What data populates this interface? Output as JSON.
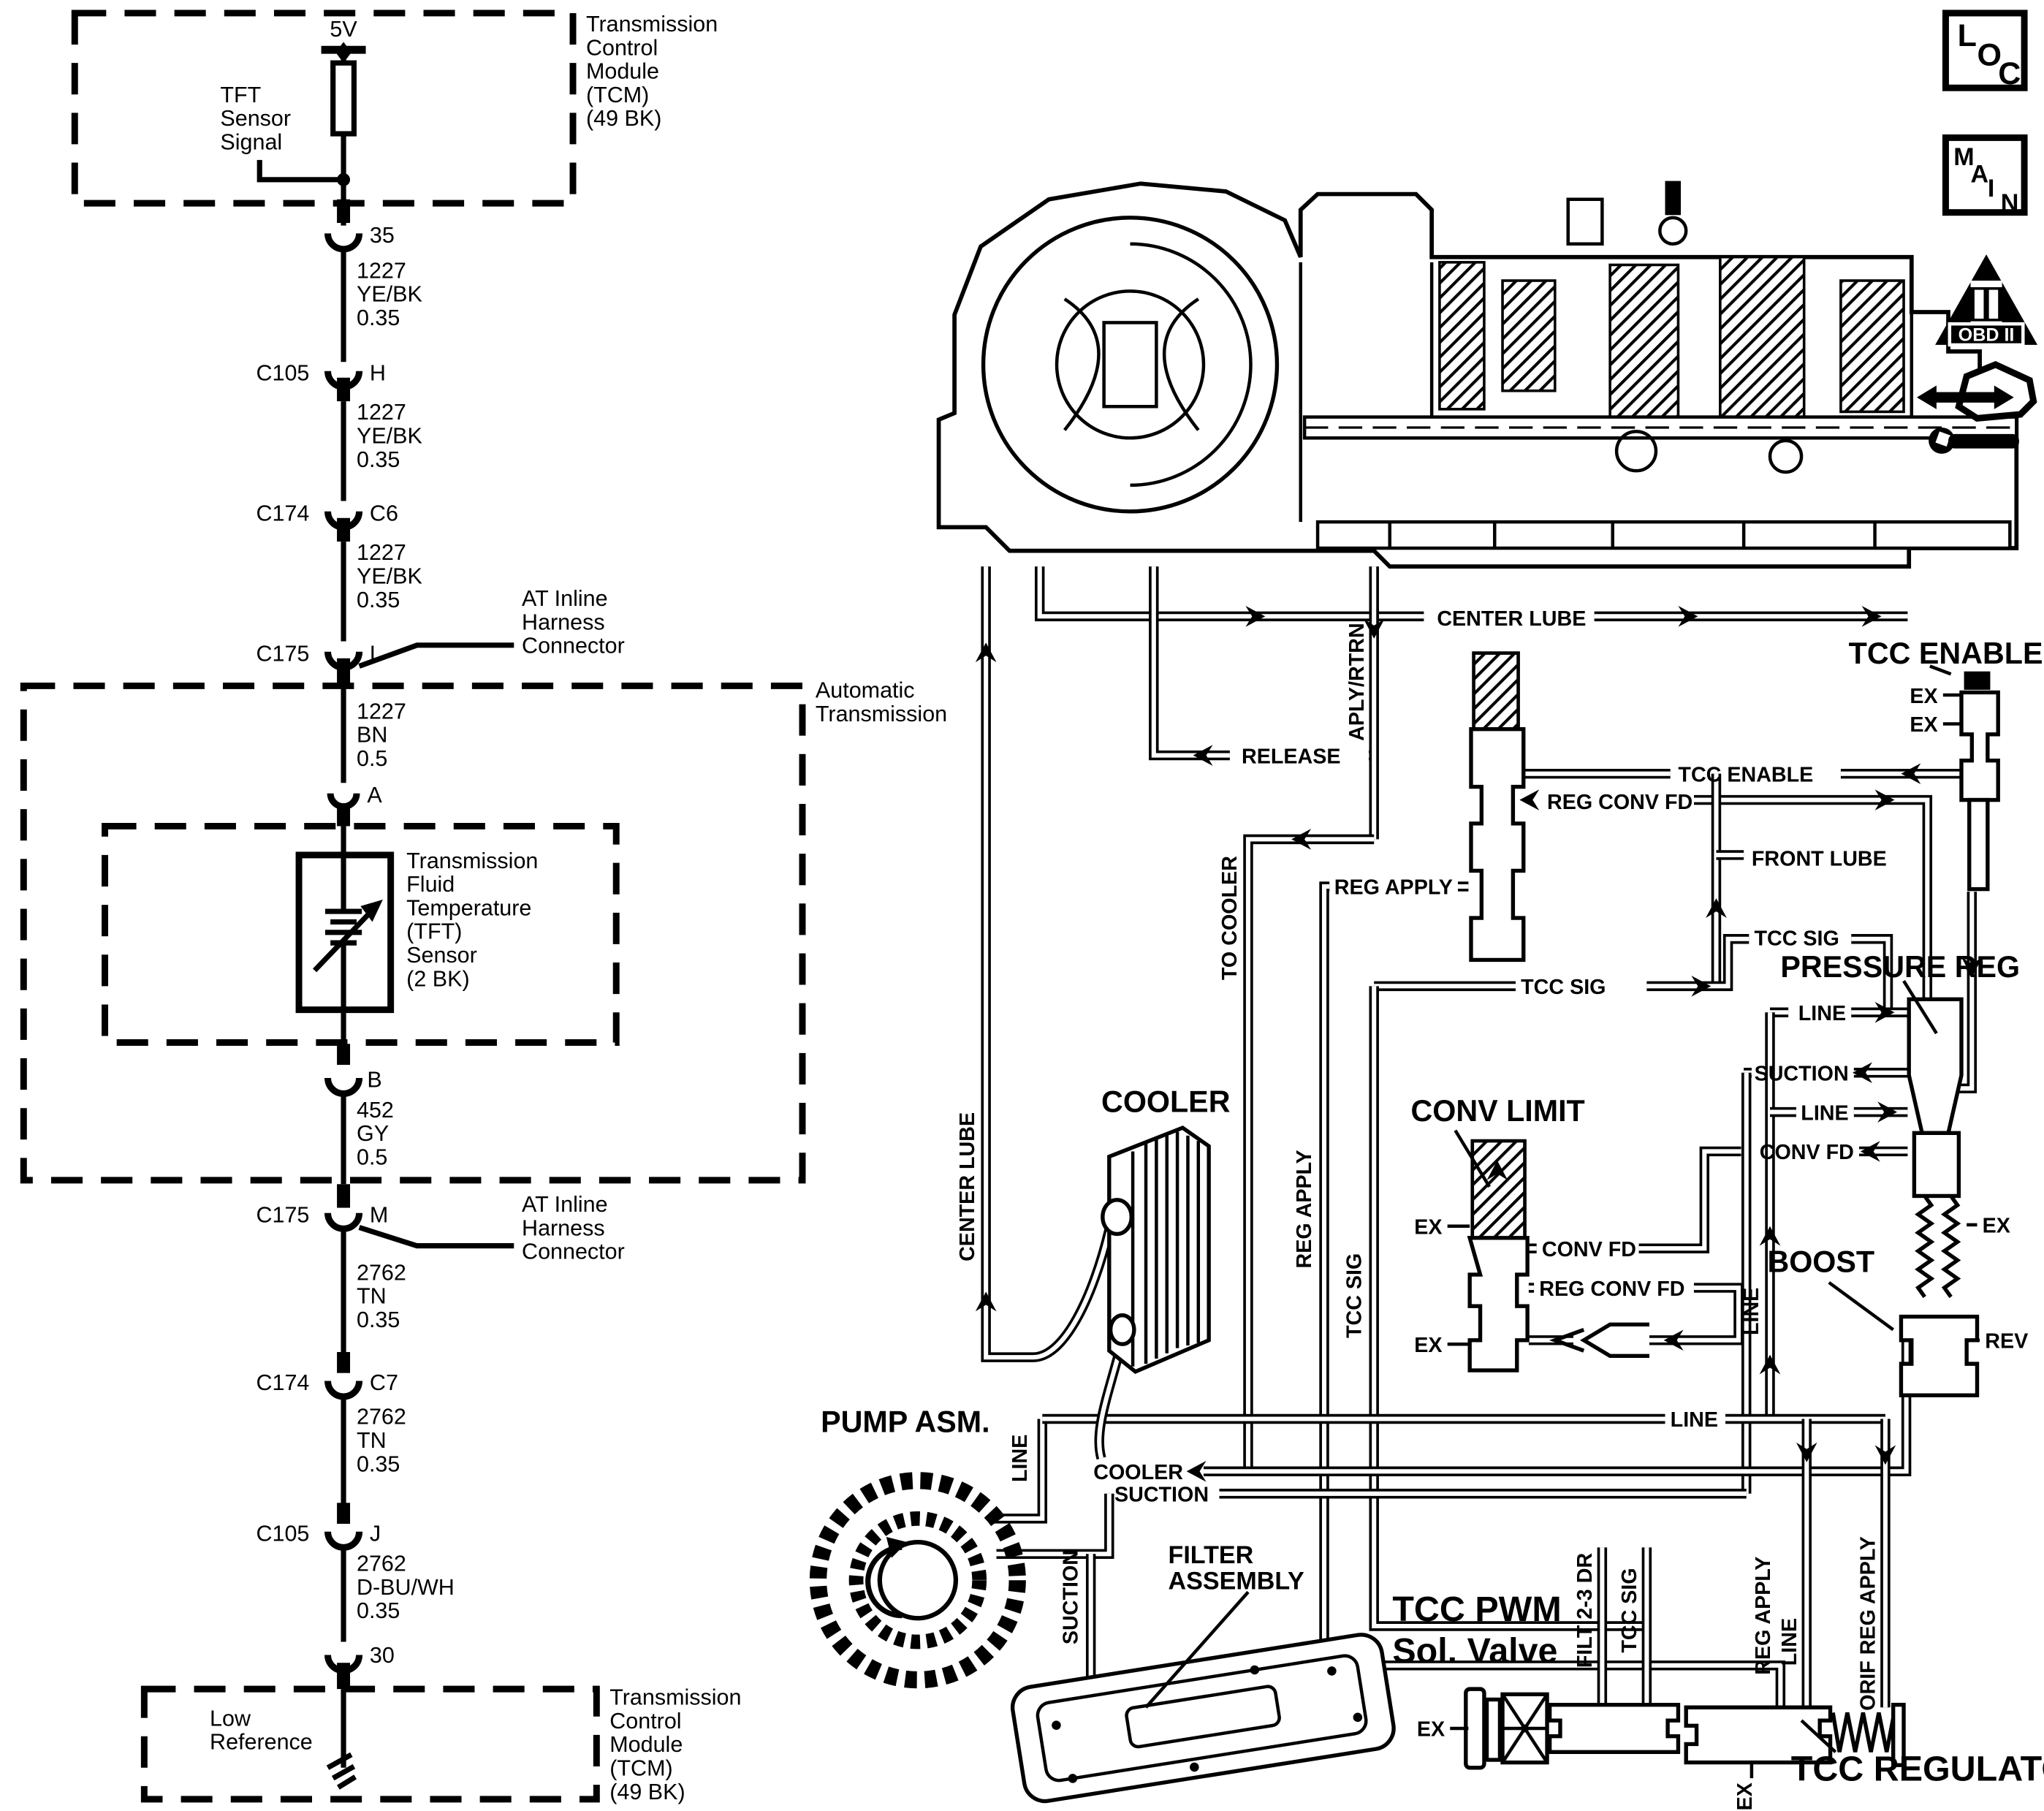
{
  "colors": {
    "ink": "#000000",
    "paper": "#ffffff"
  },
  "icons": {
    "loc": [
      "L",
      "O",
      "C"
    ],
    "main": [
      "M",
      "A",
      "I",
      "N"
    ],
    "obd_badge": "OBD II"
  },
  "wiring": {
    "supply": "5V",
    "sensor_signal_lines": [
      "TFT",
      "Sensor",
      "Signal"
    ],
    "tcm_label_lines": [
      "Transmission",
      "Control",
      "Module",
      "(TCM)",
      "(49 BK)"
    ],
    "pin_35": "35",
    "pin_30": "30",
    "pin_a": "A",
    "pin_b": "B",
    "at_inline_lines": [
      "AT Inline",
      "Harness",
      "Connector"
    ],
    "auto_trans_lines": [
      "Automatic",
      "Transmission"
    ],
    "tft_sensor_lines": [
      "Transmission",
      "Fluid",
      "Temperature",
      "(TFT)",
      "Sensor",
      "(2 BK)"
    ],
    "low_reference_lines": [
      "Low",
      "Reference"
    ],
    "wires": [
      {
        "circuit": "1227",
        "color": "YE/BK",
        "size": "0.35"
      },
      {
        "circuit": "1227",
        "color": "YE/BK",
        "size": "0.35"
      },
      {
        "circuit": "1227",
        "color": "YE/BK",
        "size": "0.35"
      },
      {
        "circuit": "1227",
        "color": "BN",
        "size": "0.5"
      },
      {
        "circuit": "452",
        "color": "GY",
        "size": "0.5"
      },
      {
        "circuit": "2762",
        "color": "TN",
        "size": "0.35"
      },
      {
        "circuit": "2762",
        "color": "TN",
        "size": "0.35"
      },
      {
        "circuit": "2762",
        "color": "D-BU/WH",
        "size": "0.35"
      }
    ],
    "connectors": [
      {
        "name": "C105",
        "pin": "H"
      },
      {
        "name": "C174",
        "pin": "C6"
      },
      {
        "name": "C175",
        "pin": "L"
      },
      {
        "name": "C175",
        "pin": "M"
      },
      {
        "name": "C174",
        "pin": "C7"
      },
      {
        "name": "C105",
        "pin": "J"
      }
    ]
  },
  "hydraulic": {
    "center_lube_h": "CENTER LUBE",
    "center_lube_v": "CENTER LUBE",
    "release": "RELEASE",
    "aply_rtrn": "APLY/RTRN",
    "tcc_enable_title": "TCC ENABLE",
    "tcc_enable_pipe": "TCC ENABLE",
    "ex_enable_1": "EX",
    "ex_enable_2": "EX",
    "reg_conv_fd_upper": "REG CONV FD",
    "front_lube": "FRONT LUBE",
    "reg_apply_h": "REG APPLY",
    "to_cooler": "TO COOLER",
    "tcc_sig_upper": "TCC SIG",
    "tcc_sig_mid": "TCC SIG",
    "tcc_sig_v1": "TCC SIG",
    "tcc_sig_v2": "TCC SIG",
    "pressure_reg_title": "PRESSURE REG",
    "line_port_top": "LINE",
    "suction_port": "SUCTION",
    "line_port_mid": "LINE",
    "conv_fd_port": "CONV FD",
    "ex_pressure_reg": "EX",
    "rev_port": "REV",
    "boost_title": "BOOST",
    "cooler_title": "COOLER",
    "conv_limit_title": "CONV LIMIT",
    "ex_conv_upper": "EX",
    "ex_conv_lower": "EX",
    "conv_fd_label": "CONV FD",
    "reg_conv_fd_lower": "REG CONV FD",
    "line_v_right": "LINE",
    "line_h_bottom": "LINE",
    "pump_title": "PUMP ASM.",
    "line_v_pump": "LINE",
    "cooler_return": "COOLER",
    "suction_h": "SUCTION",
    "suction_v": "SUCTION",
    "filter_lines": [
      "FILTER",
      "ASSEMBLY"
    ],
    "tcc_pwm_lines": [
      "TCC PWM",
      "Sol. Valve"
    ],
    "ex_solenoid": "EX",
    "filt_2_3_dr": "FILT 2-3 DR",
    "reg_apply_v1": "REG APPLY",
    "reg_apply_v2": "REG APPLY",
    "line_v_reg": "LINE",
    "orif_reg_apply": "ORIF REG APPLY",
    "ex_regulator": "EX",
    "tcc_regulator_title": "TCC REGULATOR"
  }
}
